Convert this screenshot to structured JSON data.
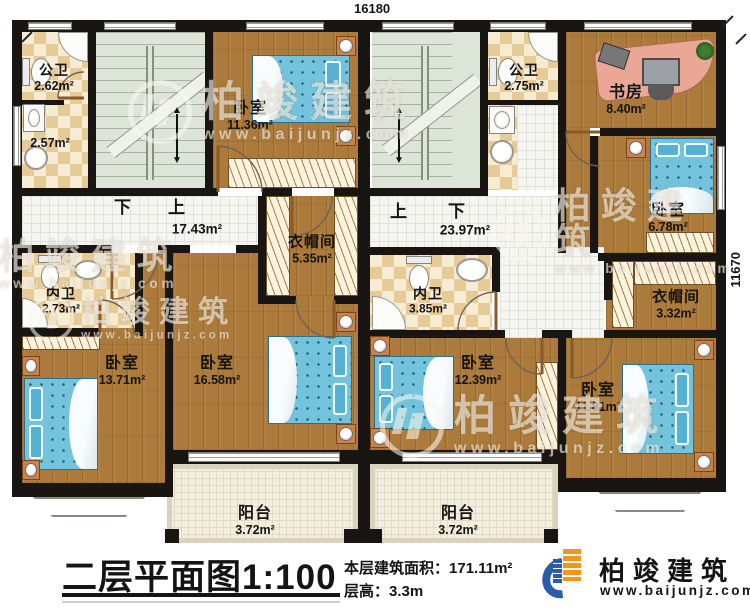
{
  "meta": {
    "dim_top": "16180",
    "dim_right": "11670"
  },
  "rooms": {
    "gongwei_left": {
      "name": "公卫",
      "area": "2.62m²"
    },
    "laundry_left": {
      "area": "2.57m²"
    },
    "bedroom_1136": {
      "name": "卧室",
      "area": "11.36m²"
    },
    "gongwei_right": {
      "name": "公卫",
      "area": "2.75m²"
    },
    "study": {
      "name": "书房",
      "area": "8.40m²"
    },
    "bedroom_678": {
      "name": "卧室",
      "area": "6.78m²"
    },
    "hall_left": {
      "area": "17.43m²",
      "down": "下",
      "up": "上"
    },
    "hall_right": {
      "area": "23.97m²",
      "up": "上",
      "down": "下"
    },
    "cloak_left": {
      "name": "衣帽间",
      "area": "5.35m²"
    },
    "cloak_right": {
      "name": "衣帽间",
      "area": "3.32m²"
    },
    "neiwei_left": {
      "name": "内卫",
      "area": "2.73m²"
    },
    "neiwei_right": {
      "name": "内卫",
      "area": "3.85m²"
    },
    "bedroom_1371": {
      "name": "卧室",
      "area": "13.71m²"
    },
    "bedroom_1658": {
      "name": "卧室",
      "area": "16.58m²"
    },
    "bedroom_1239": {
      "name": "卧室",
      "area": "12.39m²"
    },
    "bedroom_1181": {
      "name": "卧室",
      "area": "11.81m²"
    },
    "balcony_left": {
      "name": "阳台",
      "area": "3.72m²"
    },
    "balcony_right": {
      "name": "阳台",
      "area": "3.72m²"
    }
  },
  "title_block": {
    "title": "二层平面图",
    "scale": "1:100",
    "area_label": "本层建筑面积：",
    "area_value": "171.11m²",
    "height_label": "层高：",
    "height_value": "3.3m"
  },
  "brand": {
    "name": "柏竣建筑",
    "url": "www.baijunjz.com"
  },
  "watermark": {
    "name": "柏竣建筑",
    "url": "www.baijunjz.com"
  },
  "colors": {
    "wall": "#181512",
    "wood": "#ac7a3a",
    "tile_light": "#f6ecd4",
    "tile_dark": "#e7cb96",
    "corridor": "#f5f5f1",
    "stair": "#dde4d8",
    "balcony": "#f3eedd",
    "bed": "#74c3dc",
    "brand_blue": "#2a5caa",
    "brand_orange": "#f7941d"
  }
}
